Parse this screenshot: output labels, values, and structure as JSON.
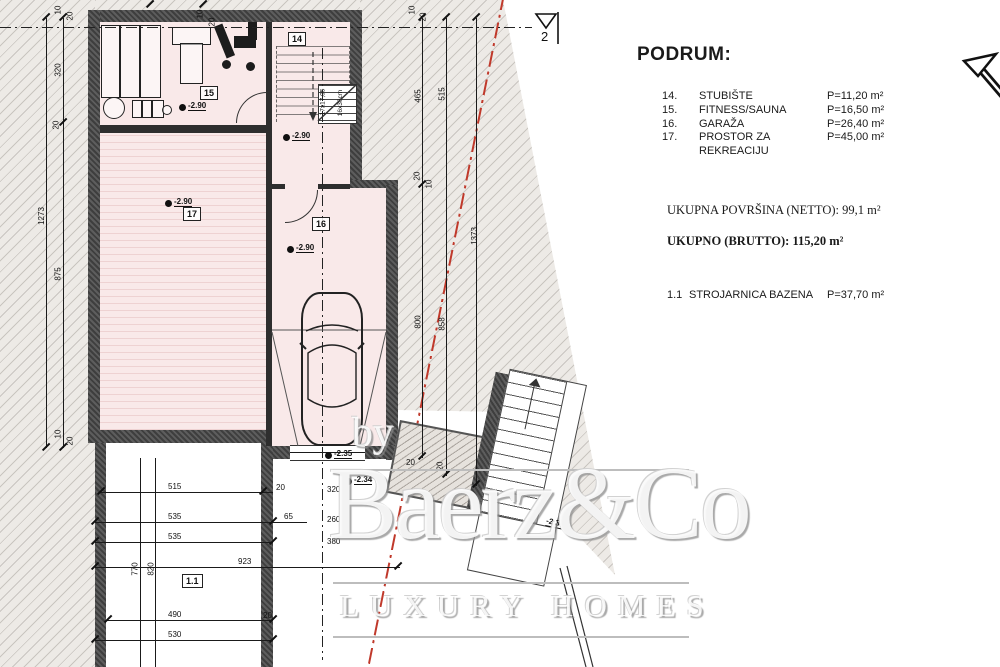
{
  "legend": {
    "title": "PODRUM:",
    "rooms": [
      {
        "num": "14.",
        "name": "STUBIŠTE",
        "area": "P=11,20 m²"
      },
      {
        "num": "15.",
        "name": "FITNESS/SAUNA",
        "area": "P=16,50 m²"
      },
      {
        "num": "16.",
        "name": "GARAŽA",
        "area": "P=26,40 m²"
      },
      {
        "num": "17.",
        "name": "PROSTOR ZA REKREACIJU",
        "area": "P=45,00 m²"
      }
    ],
    "netto": "UKUPNA POVRŠINA (NETTO): 99,1 m²",
    "brutto": "UKUPNO (BRUTTO): 115,20 m²",
    "extra": {
      "num": "1.1",
      "name": "STROJARNICA BAZENA",
      "area": "P=37,70 m²"
    }
  },
  "watermark": {
    "by": "by",
    "name": "Baerz&Co",
    "tagline": "LUXURY HOMES"
  },
  "plan": {
    "section_marker": "2",
    "tags": {
      "r14": "14",
      "r15": "15",
      "r16": "16",
      "r17": "17",
      "r11": "1.1"
    },
    "stair_note1": "17x17,05",
    "stair_note2": "16x36cm",
    "levels": [
      "-2.90",
      "-2.90",
      "-2.90",
      "-2.90",
      "-2.35",
      "-2.34",
      "-2.34"
    ],
    "dims": [
      "1273",
      "320",
      "20",
      "875",
      "10",
      "20",
      "10",
      "20",
      "465",
      "515",
      "800",
      "858",
      "1373",
      "20",
      "10",
      "20",
      "515",
      "535",
      "535",
      "923",
      "490",
      "530",
      "770",
      "820",
      "65",
      "20",
      "320",
      "260",
      "380",
      "20",
      "10",
      "20",
      "10",
      "20",
      "20"
    ],
    "colors": {
      "room_fill": "#f9e9e9",
      "wall": "#4c4c4c",
      "ground": "#edeae6",
      "boundary": "#c0392b",
      "watermark_line": "#bdbdbd"
    }
  }
}
